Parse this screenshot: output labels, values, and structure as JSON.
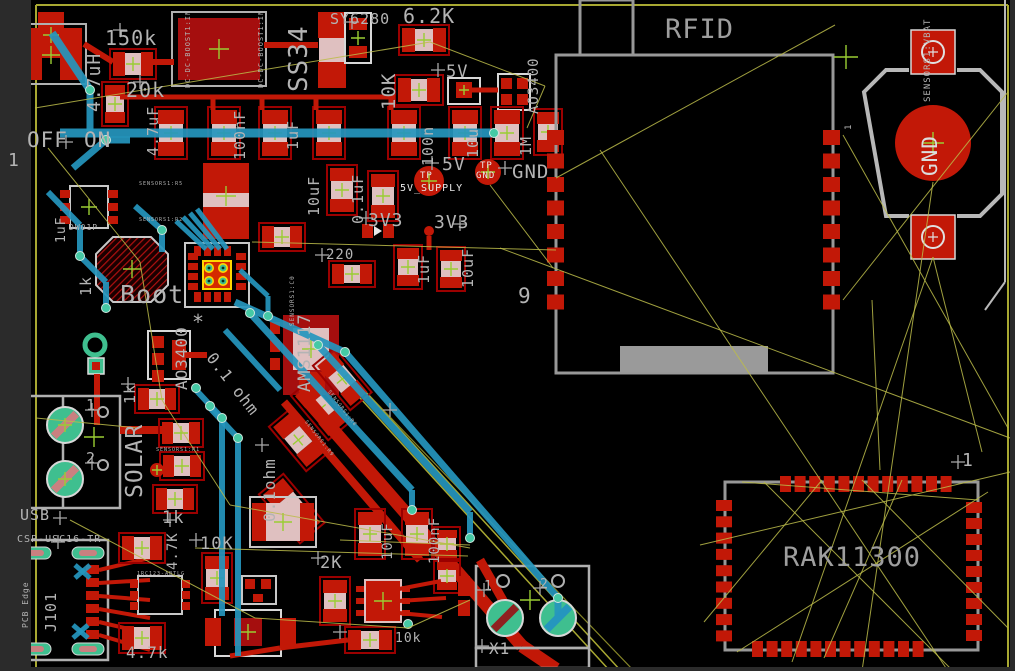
{
  "app": {
    "view": "pcb-board-editor-canvas"
  },
  "colors": {
    "copper": "#c21807",
    "copper_dark": "#8f0000",
    "silk": "#b4b4b4",
    "trace_blue": "#2596be",
    "airwire": "#bcbc4a",
    "pad_green": "#3fbf8f",
    "via_teal": "#45c9a5",
    "body_pink": "#dfc0c0",
    "origin_cross": "#9acd32",
    "board_edge": "#a8a832",
    "background": "#000000",
    "gutter": "#2b2b2b"
  },
  "modules": {
    "rfid": "RFID",
    "rak": "RAK11300",
    "boost": "DC-DC-BOOST1:IN",
    "sensors_vbat": "SENSORS1:VBAT",
    "usb_part": "CSP-USC16-TR"
  },
  "labels": [
    {
      "name": "inductor-value",
      "text": "4.7uH",
      "x": 86,
      "y": 112,
      "rot": -90,
      "size": 18
    },
    {
      "name": "resistor-150k",
      "text": "150k",
      "x": 105,
      "y": 28,
      "rot": 0,
      "size": 20
    },
    {
      "name": "resistor-20k",
      "text": "20k",
      "x": 126,
      "y": 80,
      "rot": 0,
      "size": 20
    },
    {
      "name": "boost-module-pin-left",
      "text": "DC-DC-BOOST1:IN",
      "x": 185,
      "y": 88,
      "rot": -90,
      "size": 7
    },
    {
      "name": "boost-module-pin-right",
      "text": "DC-DC-BOOST1:IN",
      "x": 258,
      "y": 88,
      "rot": -90,
      "size": 7
    },
    {
      "name": "diode-ss34",
      "text": "SS34",
      "x": 286,
      "y": 92,
      "rot": -90,
      "size": 26
    },
    {
      "name": "ic-sy6280",
      "text": "SY6280",
      "x": 330,
      "y": 12,
      "rot": 0,
      "size": 15
    },
    {
      "name": "resistor-6p2k",
      "text": "6.2K",
      "x": 403,
      "y": 6,
      "rot": 0,
      "size": 20
    },
    {
      "name": "resistor-10k-top",
      "text": "10K",
      "x": 380,
      "y": 110,
      "rot": -90,
      "size": 19
    },
    {
      "name": "net-5v-top",
      "text": "5V",
      "x": 446,
      "y": 64,
      "rot": 0,
      "size": 17
    },
    {
      "name": "fet-ao3400-top",
      "text": "AO3400",
      "x": 527,
      "y": 114,
      "rot": -90,
      "size": 14
    },
    {
      "name": "resistor-1m",
      "text": "1M",
      "x": 519,
      "y": 156,
      "rot": -90,
      "size": 15
    },
    {
      "name": "cap-4p7uf",
      "text": "4.7uF",
      "x": 146,
      "y": 156,
      "rot": -90,
      "size": 15
    },
    {
      "name": "cap-100nf-top",
      "text": "100nF",
      "x": 233,
      "y": 160,
      "rot": -90,
      "size": 15
    },
    {
      "name": "cap-1uf-top",
      "text": "1uF",
      "x": 286,
      "y": 150,
      "rot": -90,
      "size": 15
    },
    {
      "name": "cap-100n",
      "text": "100n",
      "x": 421,
      "y": 166,
      "rot": -90,
      "size": 15
    },
    {
      "name": "cap-10u",
      "text": "10u",
      "x": 466,
      "y": 158,
      "rot": -90,
      "size": 15
    },
    {
      "name": "switch-off",
      "text": "OFF",
      "x": 27,
      "y": 130,
      "rot": 0,
      "size": 21
    },
    {
      "name": "switch-on",
      "text": "ON",
      "x": 84,
      "y": 130,
      "rot": 0,
      "size": 21
    },
    {
      "name": "header-pin1",
      "text": "1",
      "x": 8,
      "y": 152,
      "rot": 0,
      "size": 18
    },
    {
      "name": "ic-dw01p",
      "text": "DW01P",
      "x": 69,
      "y": 224,
      "rot": 0,
      "size": 8
    },
    {
      "name": "cap-1uf-left",
      "text": "1uF",
      "x": 55,
      "y": 243,
      "rot": -90,
      "size": 13
    },
    {
      "name": "resistor-1k-left",
      "text": "1k",
      "x": 79,
      "y": 296,
      "rot": -90,
      "size": 15
    },
    {
      "name": "button-boot",
      "text": "Boot",
      "x": 120,
      "y": 282,
      "rot": 0,
      "size": 25
    },
    {
      "name": "asterisk-mark",
      "text": "*",
      "x": 192,
      "y": 312,
      "rot": 0,
      "size": 20
    },
    {
      "name": "fet-ao3400-mid",
      "text": "AO3400",
      "x": 174,
      "y": 390,
      "rot": -90,
      "size": 16
    },
    {
      "name": "resistor-0p1ohm-diag",
      "text": "0.1 ohm",
      "x": 216,
      "y": 350,
      "rot": 52,
      "size": 16
    },
    {
      "name": "resistor-0p1ohm-vert",
      "text": "0.1ohm",
      "x": 262,
      "y": 522,
      "rot": -90,
      "size": 16
    },
    {
      "name": "regulator-ams1117",
      "text": "AMS1117",
      "x": 297,
      "y": 392,
      "rot": -90,
      "size": 17
    },
    {
      "name": "tiny-sensors1-c0",
      "text": "SENSORS1:C0",
      "x": 290,
      "y": 326,
      "rot": -90,
      "size": 6
    },
    {
      "name": "resistor-220",
      "text": "220",
      "x": 326,
      "y": 248,
      "rot": 0,
      "size": 14
    },
    {
      "name": "cap-10uf-mid",
      "text": "10uF",
      "x": 307,
      "y": 216,
      "rot": -90,
      "size": 15
    },
    {
      "name": "cap-0p1uf",
      "text": "0.1uF",
      "x": 351,
      "y": 224,
      "rot": -90,
      "size": 15
    },
    {
      "name": "net-3v3-left",
      "text": "3V3",
      "x": 368,
      "y": 212,
      "rot": 0,
      "size": 18
    },
    {
      "name": "net-3v3-right",
      "text": "3V3",
      "x": 434,
      "y": 214,
      "rot": 0,
      "size": 18
    },
    {
      "name": "cap-1uf-3v3",
      "text": "1uF",
      "x": 417,
      "y": 284,
      "rot": -90,
      "size": 15
    },
    {
      "name": "cap-10uf-3v3",
      "text": "10uF",
      "x": 461,
      "y": 288,
      "rot": -90,
      "size": 15
    },
    {
      "name": "net-5v-tp",
      "text": "5V",
      "x": 442,
      "y": 156,
      "rot": 0,
      "size": 18
    },
    {
      "name": "testpoint-tp-label",
      "text": "TP",
      "x": 420,
      "y": 172,
      "rot": 0,
      "size": 9,
      "color": "#e8e8e8"
    },
    {
      "name": "testpoint-5v-supply",
      "text": "5V_SUPPLY",
      "x": 400,
      "y": 184,
      "rot": 0,
      "size": 10,
      "color": "#e8e8e8"
    },
    {
      "name": "testpoint-gnd-tp",
      "text": "TP",
      "x": 480,
      "y": 162,
      "rot": 0,
      "size": 9,
      "color": "#e8e8e8"
    },
    {
      "name": "testpoint-gnd-label",
      "text": "GND",
      "x": 476,
      "y": 172,
      "rot": 0,
      "size": 9,
      "color": "#e8e8e8"
    },
    {
      "name": "net-gnd",
      "text": "GND",
      "x": 512,
      "y": 163,
      "rot": 0,
      "size": 19
    },
    {
      "name": "module-rfid",
      "text": "RFID",
      "x": 665,
      "y": 16,
      "rot": 0,
      "size": 27,
      "color": "#9e9e9e"
    },
    {
      "name": "rfid-pin9",
      "text": "9",
      "x": 518,
      "y": 286,
      "rot": 0,
      "size": 21
    },
    {
      "name": "battery-net-vbat",
      "text": "SENSORS1:VBAT",
      "x": 924,
      "y": 102,
      "rot": -90,
      "size": 9
    },
    {
      "name": "battery-gnd",
      "text": "GND",
      "x": 920,
      "y": 176,
      "rot": -90,
      "size": 21,
      "color": "#dcdcdc"
    },
    {
      "name": "battery-pin1",
      "text": "1",
      "x": 845,
      "y": 130,
      "rot": -90,
      "size": 9
    },
    {
      "name": "solar-label",
      "text": "SOLAR",
      "x": 124,
      "y": 498,
      "rot": -90,
      "size": 23
    },
    {
      "name": "solar-pin1",
      "text": "1",
      "x": 86,
      "y": 398,
      "rot": 0,
      "size": 15
    },
    {
      "name": "solar-pin2",
      "text": "2",
      "x": 86,
      "y": 451,
      "rot": 0,
      "size": 15
    },
    {
      "name": "resistor-1k-solar",
      "text": "1k",
      "x": 123,
      "y": 404,
      "rot": -90,
      "size": 15
    },
    {
      "name": "resistor-1k-usb",
      "text": "1k",
      "x": 162,
      "y": 510,
      "rot": 0,
      "size": 17
    },
    {
      "name": "resistor-4p7k-vert",
      "text": "4.7K",
      "x": 166,
      "y": 570,
      "rot": -90,
      "size": 14
    },
    {
      "name": "usb-label",
      "text": "USB",
      "x": 20,
      "y": 508,
      "rot": 0,
      "size": 15
    },
    {
      "name": "usb-part-number",
      "text": "CSP-USC16-TR",
      "x": 17,
      "y": 535,
      "rot": 0,
      "size": 10
    },
    {
      "name": "usb-refdes-j101",
      "text": "J101",
      "x": 44,
      "y": 632,
      "rot": -90,
      "size": 15
    },
    {
      "name": "usb-pcb-edge",
      "text": "PCB Edge",
      "x": 22,
      "y": 628,
      "rot": -90,
      "size": 8
    },
    {
      "name": "resistor-4p7k-bottom",
      "text": "4.7k",
      "x": 126,
      "y": 645,
      "rot": 0,
      "size": 16
    },
    {
      "name": "resistor-10k-mid",
      "text": "10K",
      "x": 200,
      "y": 536,
      "rot": 0,
      "size": 17
    },
    {
      "name": "resistor-2k",
      "text": "2K",
      "x": 320,
      "y": 555,
      "rot": 0,
      "size": 17
    },
    {
      "name": "resistor-10k-bottom",
      "text": "10k",
      "x": 395,
      "y": 632,
      "rot": 0,
      "size": 13
    },
    {
      "name": "cap-10uf-bottom",
      "text": "10uF",
      "x": 381,
      "y": 560,
      "rot": -90,
      "size": 14
    },
    {
      "name": "cap-100nf-bottom",
      "text": "100nF",
      "x": 428,
      "y": 564,
      "rot": -90,
      "size": 14
    },
    {
      "name": "terminal-x1",
      "text": "X1",
      "x": 489,
      "y": 641,
      "rot": 0,
      "size": 16
    },
    {
      "name": "x1-pin1",
      "text": "1",
      "x": 484,
      "y": 580,
      "rot": 0,
      "size": 13
    },
    {
      "name": "x1-pin2",
      "text": "2",
      "x": 540,
      "y": 578,
      "rot": 0,
      "size": 13
    },
    {
      "name": "module-rak11300",
      "text": "RAK11300",
      "x": 783,
      "y": 544,
      "rot": 0,
      "size": 27,
      "color": "#9e9e9e"
    },
    {
      "name": "rak-pin1",
      "text": "1",
      "x": 962,
      "y": 452,
      "rot": 0,
      "size": 18
    },
    {
      "name": "tiny-sensors1-r5",
      "text": "SENSORS1:R5",
      "x": 139,
      "y": 182,
      "rot": 0,
      "size": 5
    },
    {
      "name": "tiny-sensors1-r2",
      "text": "SENSORS1:R2",
      "x": 139,
      "y": 218,
      "rot": 0,
      "size": 5
    },
    {
      "name": "tiny-sensors1-r1",
      "text": "SENSORS1:R1",
      "x": 156,
      "y": 448,
      "rot": 0,
      "size": 5
    },
    {
      "name": "tiny-sensors1-r8",
      "text": "SENSORS1:R8",
      "x": 330,
      "y": 390,
      "rot": 52,
      "size": 5
    },
    {
      "name": "tiny-sensors1-r9",
      "text": "SENSORS1:R9",
      "x": 307,
      "y": 420,
      "rot": 52,
      "size": 5
    },
    {
      "name": "tiny-part-rc",
      "text": "1RC123-ABTLG",
      "x": 137,
      "y": 572,
      "rot": 0,
      "size": 5
    }
  ]
}
